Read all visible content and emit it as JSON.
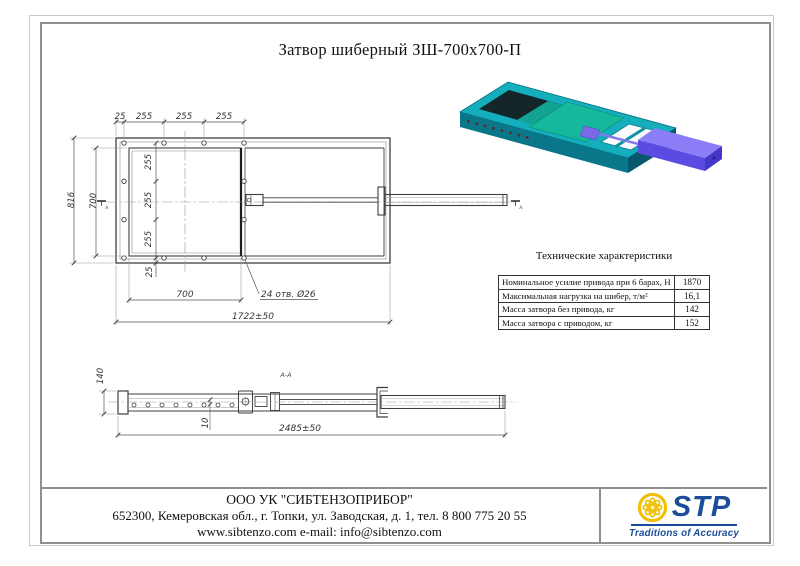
{
  "page": {
    "title": "Затвор шиберный ЗШ-700х700-П"
  },
  "dims": {
    "front": {
      "t25": "25",
      "t255a": "255",
      "t255b": "255",
      "t255c": "255",
      "h816": "816",
      "h700": "700",
      "v255a": "255",
      "v255b": "255",
      "v255c": "255",
      "v25": "25",
      "b700": "700",
      "holes": "24 отв. Ø26",
      "total": "1722±50",
      "sectionA": "А"
    },
    "side": {
      "label": "А-А",
      "h140": "140",
      "t10": "10",
      "total": "2485±50"
    }
  },
  "specs": {
    "title": "Технические характеристики",
    "rows": [
      {
        "label": "Номинальное усилие привода при 6 барах, Н",
        "value": "1870"
      },
      {
        "label": "Максимальная нагрузка на шибер, т/м²",
        "value": "16,1"
      },
      {
        "label": "Масса затвора без привода, кг",
        "value": "142"
      },
      {
        "label": "Масса затвора с приводом, кг",
        "value": "152"
      }
    ]
  },
  "footer": {
    "company": "ООО УК \"СИБТЕНЗОПРИБОР\"",
    "address": "652300, Кемеровская обл., г. Топки, ул. Заводская, д. 1, тел. 8 800 775 20 55",
    "web": "www.sibtenzo.com e-mail: info@sibtenzo.com",
    "logo": {
      "text": "STP",
      "tagline": "Traditions of Accuracy",
      "brand_color": "#1a4e9b",
      "emblem_color": "#f0c000"
    }
  },
  "render_3d": {
    "frame_color": "#14aebc",
    "gate_color": "#16b89c",
    "actuator_color": "#5b4be0"
  }
}
